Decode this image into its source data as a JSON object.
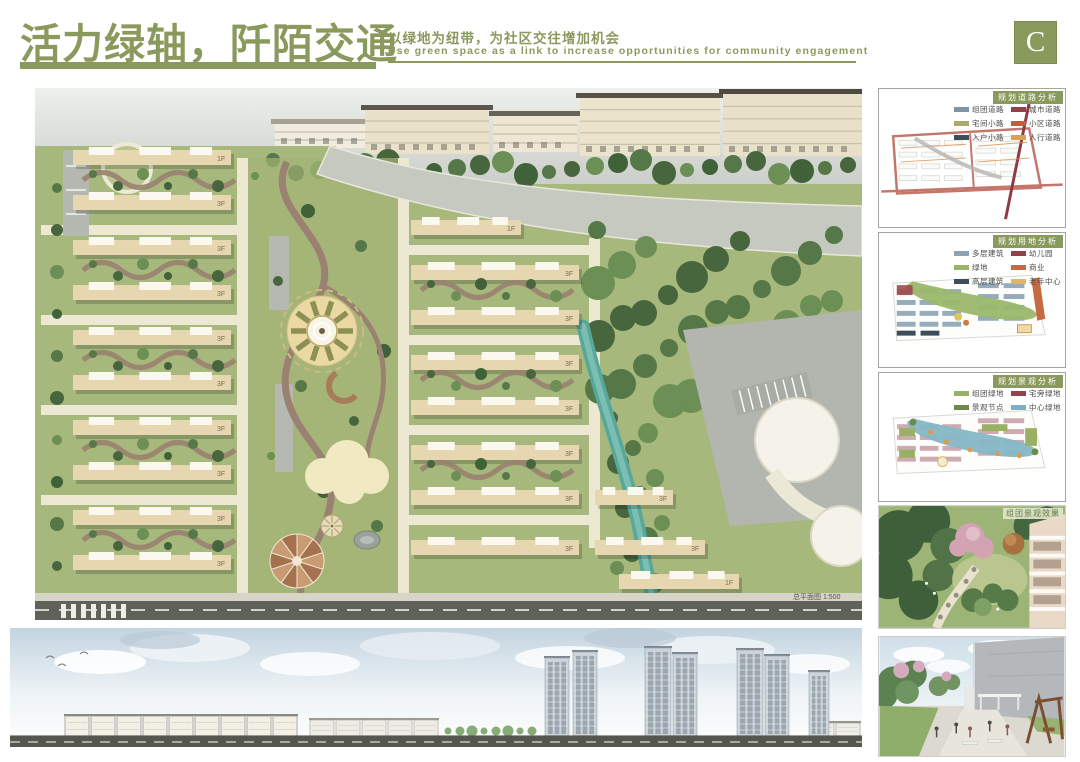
{
  "board": {
    "title_cn": "活力绿轴，阡陌交通",
    "subtitle_cn": "以绿地为纽带，为社区交往增加机会",
    "subtitle_en": "Use green space as a link to increase opportunities for community engagement",
    "letter": "C",
    "accent_color": "#8a995c"
  },
  "plan": {
    "caption": "总平面图 1:500",
    "floor_label": "3F",
    "floor_label_alt": "1F"
  },
  "sidebar": {
    "diagrams": [
      {
        "title": "规划道路分析",
        "legend": [
          {
            "label": "组团道路",
            "color": "#7d95a6"
          },
          {
            "label": "宅间小路",
            "color": "#a8ab6d"
          },
          {
            "label": "入户小路",
            "color": "#3d4d5c"
          },
          {
            "label": "城市道路",
            "color": "#94414b"
          },
          {
            "label": "小区道路",
            "color": "#bf5f3e"
          },
          {
            "label": "人行道路",
            "color": "#dd9f54"
          }
        ]
      },
      {
        "title": "规划用地分析",
        "legend": [
          {
            "label": "多层建筑",
            "color": "#8ba3b5"
          },
          {
            "label": "绿地",
            "color": "#98b56d"
          },
          {
            "label": "高层建筑",
            "color": "#3d4d5c"
          },
          {
            "label": "幼儿园",
            "color": "#94414b"
          },
          {
            "label": "商业",
            "color": "#c66a42"
          },
          {
            "label": "老年中心",
            "color": "#e2b36a"
          }
        ]
      },
      {
        "title": "规划景观分析",
        "legend": [
          {
            "label": "组团绿地",
            "color": "#9ab065"
          },
          {
            "label": "景观节点",
            "color": "#6d8a4a"
          },
          {
            "label": "宅旁绿地",
            "color": "#94414b"
          },
          {
            "label": "中心绿地",
            "color": "#7fb0bf"
          }
        ]
      }
    ],
    "photos": [
      {
        "label": "组团景观效果"
      },
      {
        "label": ""
      }
    ]
  }
}
